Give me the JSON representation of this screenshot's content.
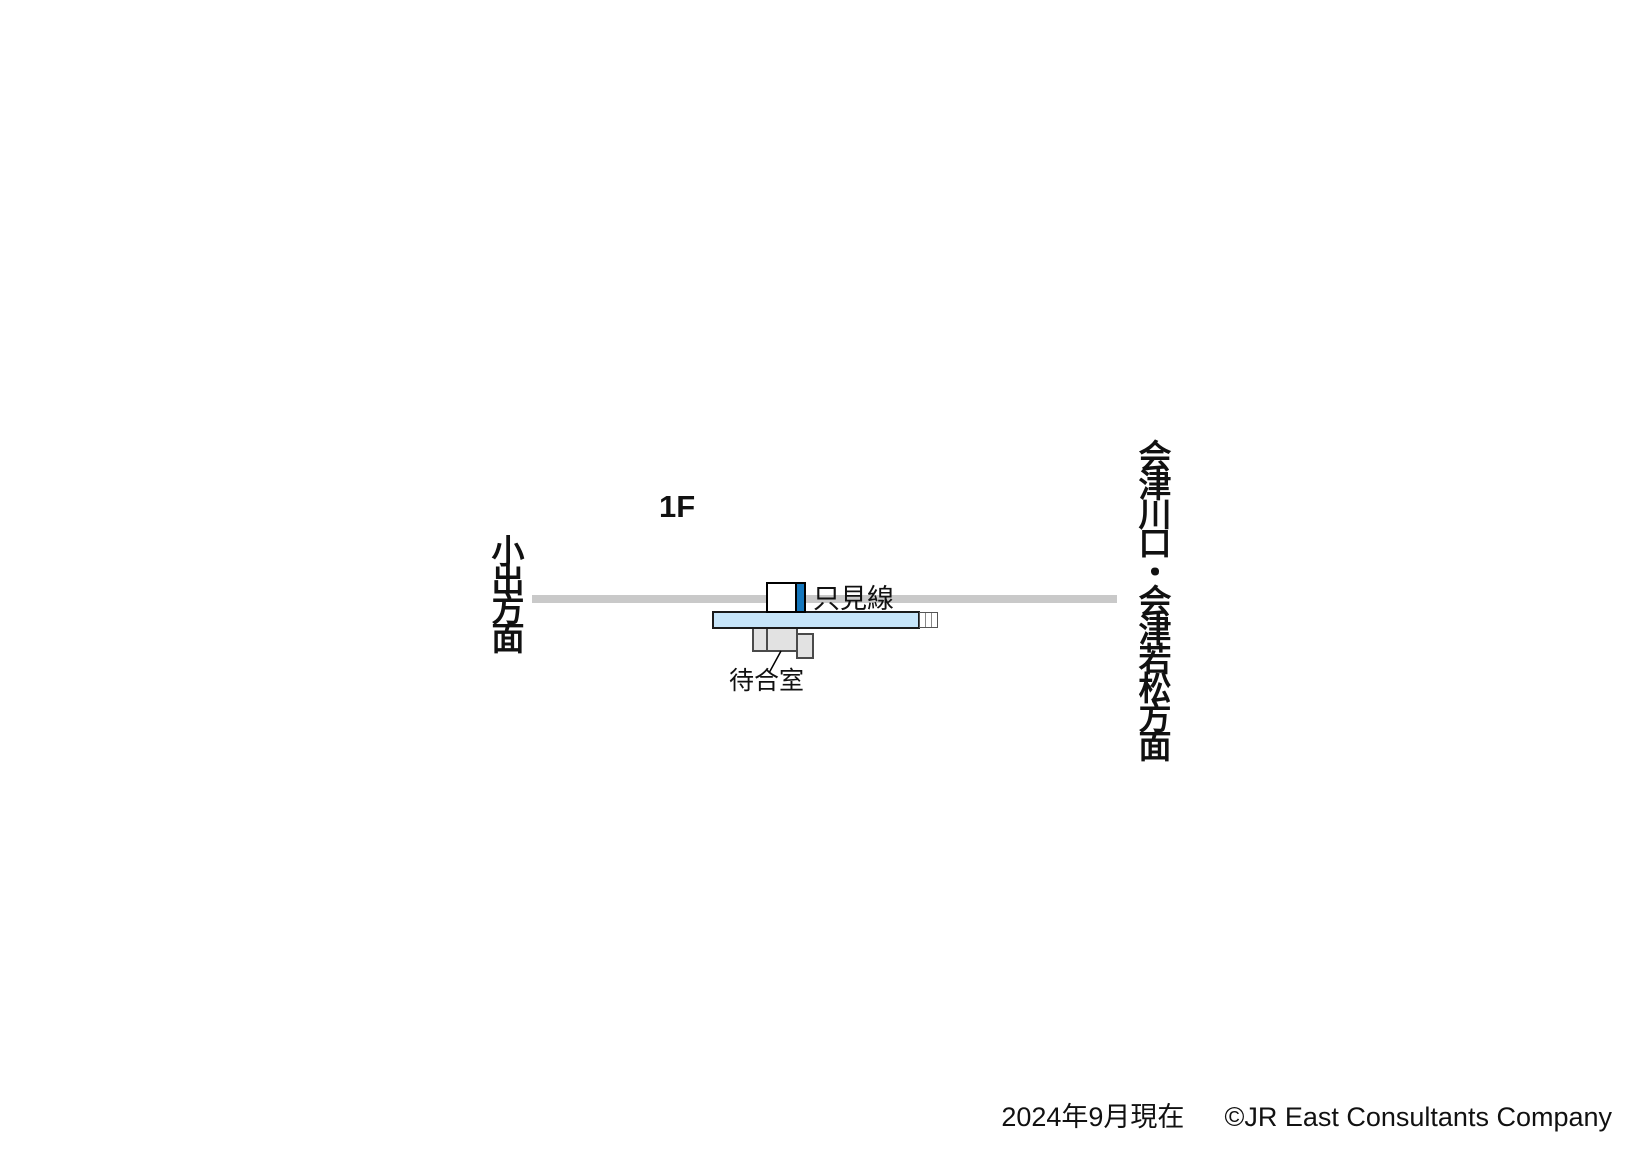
{
  "map": {
    "floor_label": "1F",
    "line_label": "只見線",
    "waiting_room_label": "待合室",
    "direction_left": "小出方面",
    "direction_right": "会津川口・会津若松方面"
  },
  "footer": {
    "date": "2024年9月現在",
    "copyright": "©JR East Consultants Company"
  },
  "colors": {
    "track_gray": "#c9c9c9",
    "platform_fill": "#c6e4f8",
    "platform_border": "#1a1a1a",
    "line_marker_blue": "#1577bd",
    "building_fill": "#ffffff",
    "building_border": "#000000",
    "structure_fill": "#e2e2e2",
    "structure_border": "#4a4a4a"
  }
}
